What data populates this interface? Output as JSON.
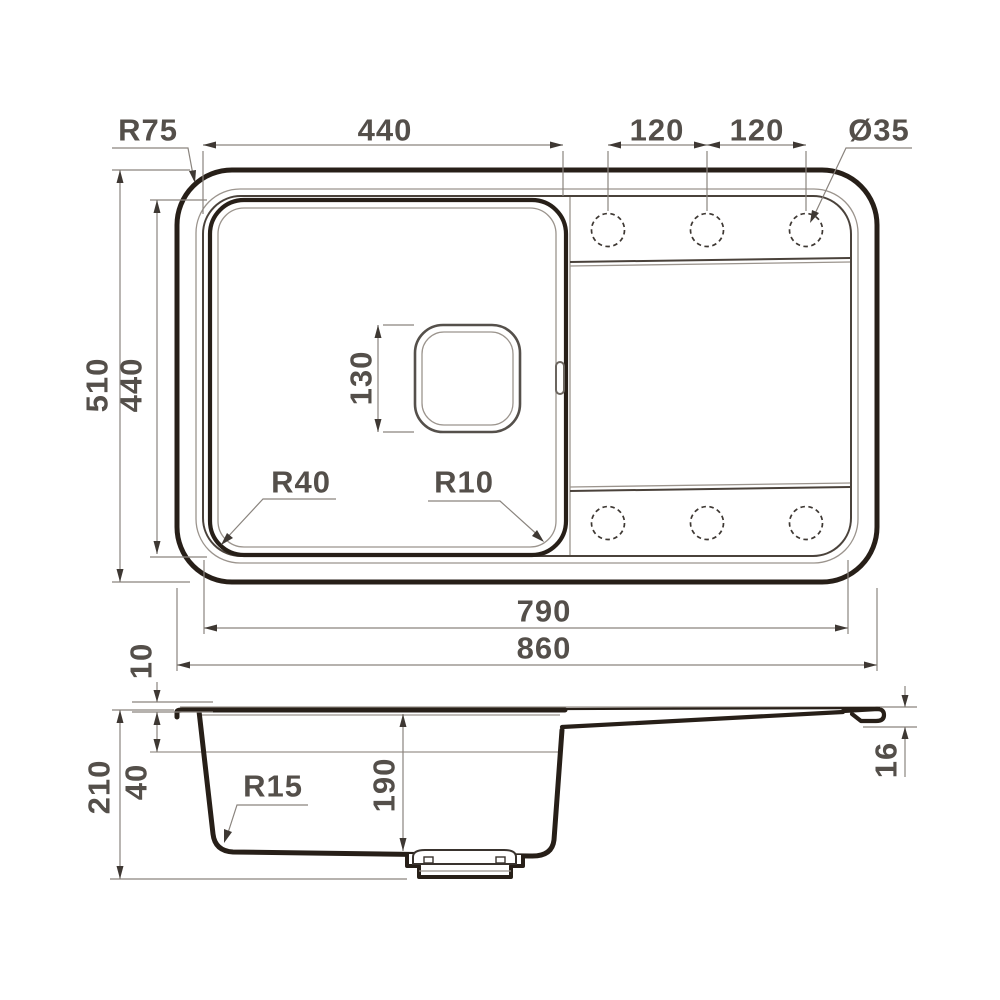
{
  "drawing_title": "Kitchen sink dimensional drawing",
  "top_view": {
    "dims": {
      "outer_corner_radius": "R75",
      "bowl_width": "440",
      "tap_spacing_1": "120",
      "tap_spacing_2": "120",
      "tap_hole_diameter": "Ø35",
      "overall_depth": "510",
      "bowl_depth": "440",
      "drain_size": "130",
      "bowl_corner_radius": "R40",
      "bowl_inner_radius": "R10",
      "inner_length": "790",
      "overall_length": "860"
    }
  },
  "section_view": {
    "dims": {
      "rim_height": "10",
      "overall_height": "210",
      "edge_depth": "40",
      "bottom_radius": "R15",
      "bowl_depth": "190",
      "edge_thickness": "16"
    }
  }
}
